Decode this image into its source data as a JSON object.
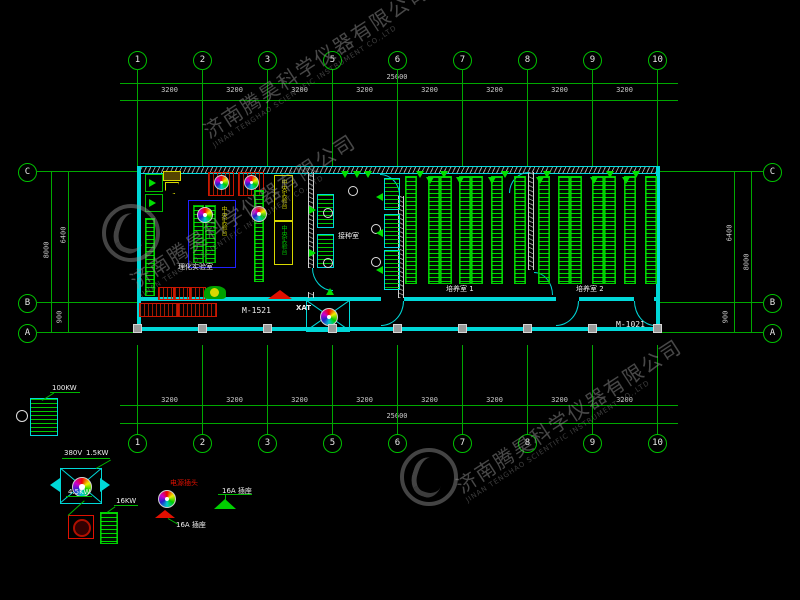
{
  "watermark": {
    "cn": "济南腾昊科学仪器有限公司",
    "en": "JINAN TENGHAO SCIENTIFIC INSTRUMENT CO.,LTD"
  },
  "grid": {
    "column_labels": [
      "1",
      "2",
      "3",
      "5",
      "6",
      "7",
      "8",
      "9",
      "10"
    ],
    "bay_dim": "3200",
    "total_dim": "25600",
    "row_labels": [
      "C",
      "B",
      "A"
    ],
    "row_dims": {
      "outer": "8000",
      "inner_top": "6400",
      "inner_bottom": "900"
    }
  },
  "plan": {
    "room_labels": [
      {
        "text": "理化实验室"
      },
      {
        "text": "接种室"
      },
      {
        "text": "培养室 1"
      },
      {
        "text": "培养室 2"
      }
    ],
    "bench_label_island": "中央实验台",
    "bench_label_yellow": "中央实验台",
    "bench_label_green": "中央实验台",
    "door_marks": [
      "M-1521",
      "M-1021"
    ],
    "fan_mark": "XAT"
  },
  "legend": {
    "ahu_power": "100KW",
    "fan_voltage": "380V",
    "fan_power": "1.5KW",
    "heater_power": "4.5KW",
    "rack_power": "16KW",
    "plug_label": "电源插头",
    "socket_label_1": "16A 插座",
    "socket_label_2": "16A 插座"
  },
  "colors": {
    "grid_green": "#00a800",
    "wall_cyan": "#00d8d8",
    "equipment_green": "#00e000",
    "alert_red": "#ff1500",
    "bench_yellow": "#d8d800",
    "island_blue": "#2020ff"
  },
  "geometry": {
    "col_x": [
      137,
      202,
      267,
      332,
      397,
      462,
      527,
      592,
      657
    ],
    "row_y": [
      171,
      302,
      332
    ],
    "rack_rooms": [
      {
        "x_list": [
          405,
          428,
          440,
          459,
          471,
          491,
          514
        ],
        "y": 176,
        "h": 106
      },
      {
        "x_list": [
          538,
          558,
          570,
          592,
          604,
          624,
          645
        ],
        "y": 176,
        "h": 106
      }
    ],
    "ceiling_circles": [
      [
        327,
        212
      ],
      [
        327,
        262
      ],
      [
        352,
        190
      ],
      [
        375,
        228
      ],
      [
        375,
        261
      ]
    ],
    "triangles": [
      [
        345,
        171,
        "d"
      ],
      [
        368,
        171,
        "d"
      ],
      [
        420,
        171,
        "d"
      ],
      [
        444,
        171,
        "d"
      ],
      [
        505,
        171,
        "d"
      ],
      [
        547,
        171,
        "d"
      ],
      [
        610,
        171,
        "d"
      ],
      [
        636,
        171,
        "d"
      ],
      [
        313,
        206,
        "r"
      ],
      [
        313,
        249,
        "r"
      ],
      [
        380,
        193,
        "l"
      ],
      [
        380,
        229,
        "l"
      ],
      [
        380,
        266,
        "l"
      ],
      [
        330,
        288,
        "u"
      ],
      [
        357,
        171,
        "d"
      ],
      [
        430,
        177,
        "d"
      ],
      [
        460,
        177,
        "d"
      ],
      [
        492,
        177,
        "d"
      ],
      [
        540,
        177,
        "d"
      ],
      [
        594,
        177,
        "d"
      ],
      [
        626,
        177,
        "d"
      ]
    ]
  }
}
